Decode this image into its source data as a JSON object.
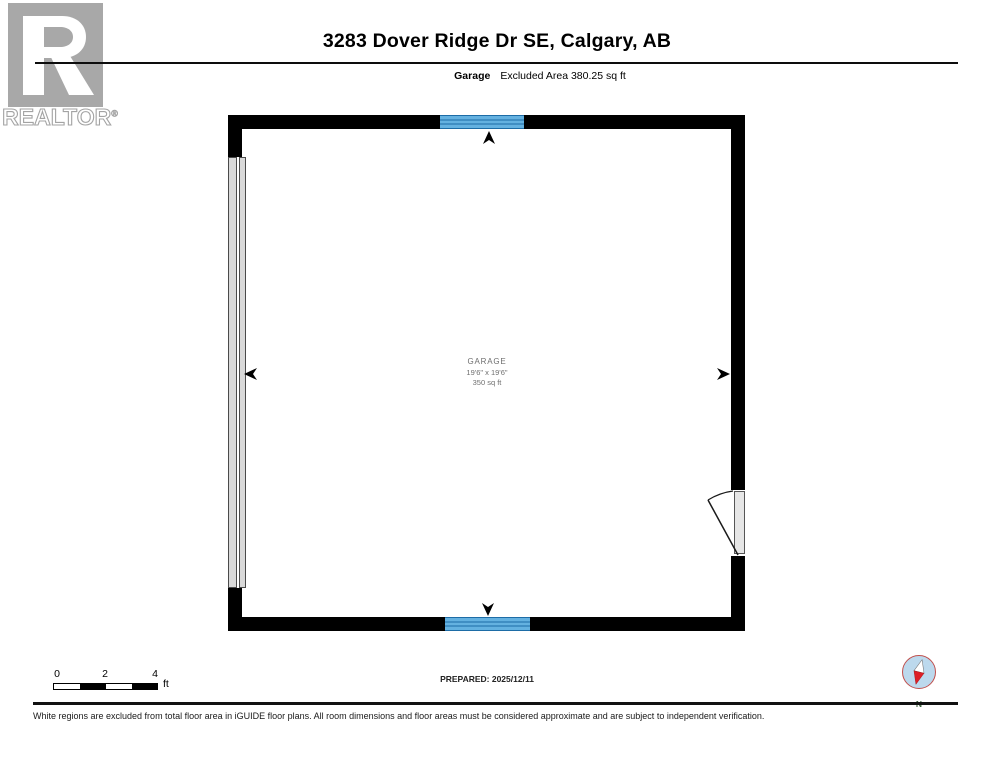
{
  "brand": {
    "logo_text": "REALTOR",
    "registered": "®"
  },
  "header": {
    "title": "3283 Dover Ridge Dr SE, Calgary, AB",
    "floor_label": "Garage",
    "area_note": "Excluded Area 380.25 sq ft"
  },
  "plan": {
    "room": {
      "name": "GARAGE",
      "dimensions": "19'6\" x 19'6\"",
      "area": "350 sq ft"
    }
  },
  "scale_bar": {
    "ticks": [
      "0",
      "2",
      "4"
    ],
    "unit": "ft"
  },
  "prepared_label": "PREPARED: 2025/12/11",
  "compass": {
    "north_label": "N"
  },
  "disclaimer": "White regions are excluded from total floor area in iGUIDE floor plans. All room dimensions and floor areas must be considered approximate and are subject to independent verification.",
  "colors": {
    "wall": "#000000",
    "window_fill": "#64b1e0",
    "window_line": "#1d6ca6",
    "door_gray": "#d9d9d9",
    "logo_gray": "#a8a8a8",
    "compass_fill": "#bcd9ed",
    "needle_red": "#dd1f26"
  }
}
